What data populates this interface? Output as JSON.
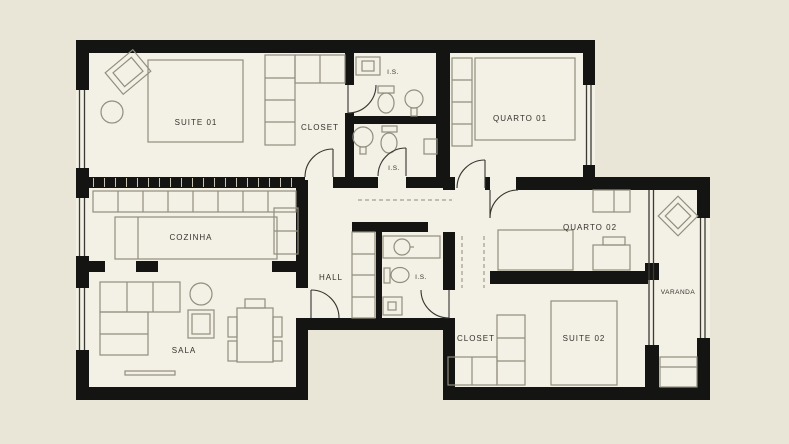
{
  "plan": {
    "rooms": {
      "suite_01": "SUITE 01",
      "closet_top": "CLOSET",
      "is_top": "I.S.",
      "is_mid": "I.S.",
      "quarto_01": "QUARTO 01",
      "cozinha": "COZINHA",
      "hall": "HALL",
      "is_center": "I.S.",
      "quarto_02": "QUARTO 02",
      "sala": "SALA",
      "closet_bottom": "CLOSET",
      "suite_02": "SUITE 02",
      "varanda": "VARANDA"
    },
    "colors": {
      "background": "#e9e5d7",
      "floor": "#f3f0e5",
      "wall": "#141412",
      "furniture_line": "#918e7e",
      "text": "#33322c"
    }
  }
}
